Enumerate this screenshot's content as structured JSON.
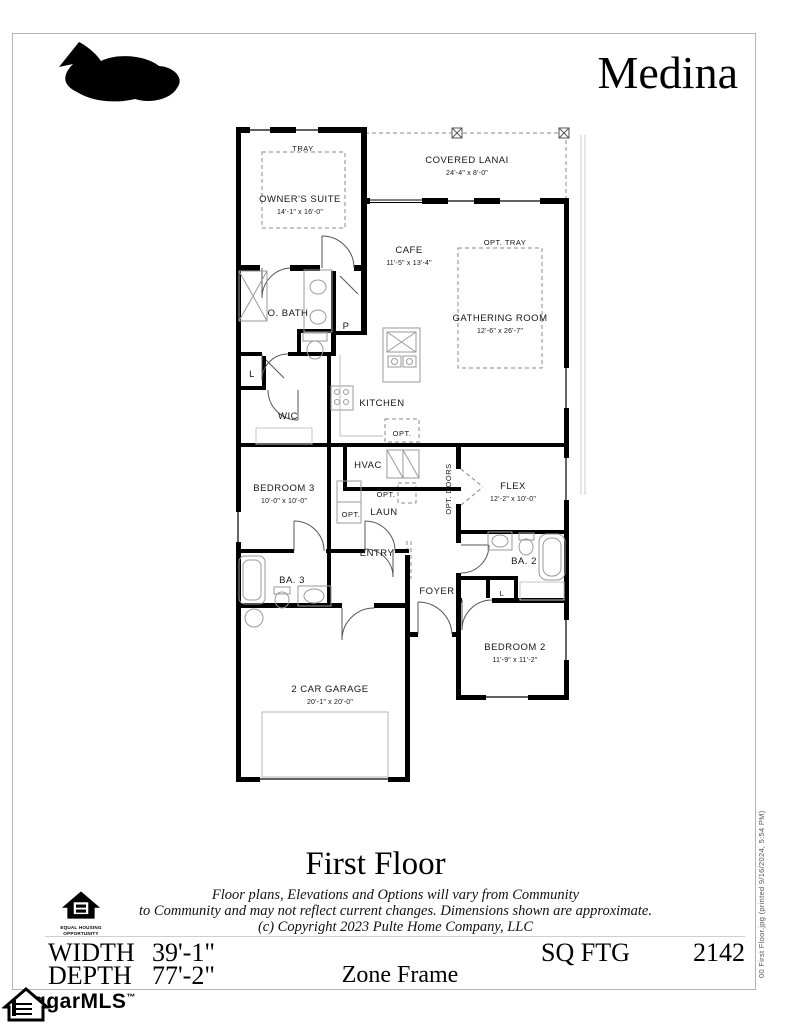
{
  "header": {
    "title": "Medina"
  },
  "plan": {
    "rooms": {
      "tray": {
        "label": "TRAY"
      },
      "owners_suite": {
        "label": "OWNER'S SUITE",
        "dims": "14'-1\" x 16'-0\""
      },
      "covered_lanai": {
        "label": "COVERED LANAI",
        "dims": "24'-4\" x 8'-0\""
      },
      "cafe": {
        "label": "CAFE",
        "dims": "11'-5\" x 13'-4\""
      },
      "opt_tray": {
        "label": "OPT. TRAY"
      },
      "gathering_room": {
        "label": "GATHERING ROOM",
        "dims": "12'-6\" x 26'-7\""
      },
      "o_bath": {
        "label": "O. BATH"
      },
      "pantry": {
        "label": "P"
      },
      "linen1": {
        "label": "L"
      },
      "wic": {
        "label": "WIC"
      },
      "kitchen": {
        "label": "KITCHEN"
      },
      "opt_kitchen": {
        "label": "OPT."
      },
      "hvac": {
        "label": "HVAC"
      },
      "opt_hvac": {
        "label": "OPT."
      },
      "laun": {
        "label": "LAUN"
      },
      "opt_laun": {
        "label": "OPT."
      },
      "bedroom3": {
        "label": "BEDROOM 3",
        "dims": "10'-0\" x 10'-0\""
      },
      "opt_doors": {
        "label": "OPT. DOORS"
      },
      "flex": {
        "label": "FLEX",
        "dims": "12'-2\" x 10'-0\""
      },
      "entry": {
        "label": "ENTRY"
      },
      "ba3": {
        "label": "BA. 3"
      },
      "foyer": {
        "label": "FOYER"
      },
      "ba2": {
        "label": "BA. 2"
      },
      "linen2": {
        "label": "L"
      },
      "bedroom2": {
        "label": "BEDROOM 2",
        "dims": "11'-9\" x 11'-2\""
      },
      "garage": {
        "label": "2 CAR GARAGE",
        "dims": "20'-1\" x 20'-0\""
      }
    }
  },
  "footer": {
    "floor_title": "First Floor",
    "disclaimer_line1": "Floor plans, Elevations and Options will vary from Community",
    "disclaimer_line2": "to Community and may not reflect current changes.  Dimensions shown are approximate.",
    "disclaimer_line3": "(c) Copyright 2023 Pulte Home Company, LLC",
    "equal_housing_line1": "EQUAL HOUSING",
    "equal_housing_line2": "OPPORTUNITY",
    "width_label": "WIDTH",
    "width_value": "39'-1\"",
    "depth_label": "DEPTH",
    "depth_value": "77'-2\"",
    "zone": "Zone Frame",
    "sqftg_label": "SQ FTG",
    "sqftg_value": "2142"
  },
  "branding": {
    "mls_text": "ggarMLS",
    "mls_tm": "™"
  },
  "print_note": "00 First Floor.jpg (printed 9/16/2024, 5:54 PM)",
  "colors": {
    "wall": "#000000",
    "background": "#ffffff",
    "page_border": "#b3b3b3",
    "dash": "#888888"
  }
}
